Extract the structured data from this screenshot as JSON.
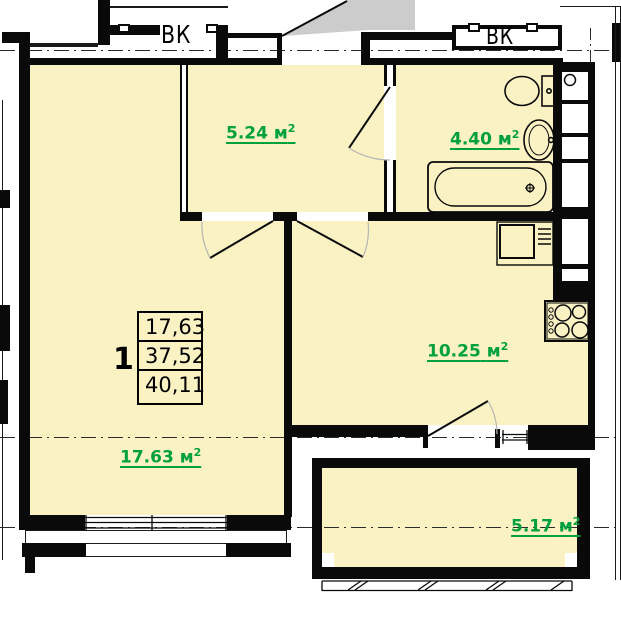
{
  "plan": {
    "vk_labels": {
      "left": "ВК",
      "right": "ВК"
    },
    "rooms": {
      "hallway": {
        "area": "5.24",
        "unit": "м",
        "power": "2"
      },
      "bathroom": {
        "area": "4.40",
        "unit": "м",
        "power": "2"
      },
      "kitchen": {
        "area": "10.25",
        "unit": "м",
        "power": "2"
      },
      "living_room": {
        "area": "17.63",
        "unit": "м",
        "power": "2"
      },
      "balcony": {
        "area": "5.17",
        "unit": "м",
        "power": "2"
      }
    },
    "apartment_stats": {
      "rooms_count": "1",
      "living_area": "17,63",
      "heated_area": "37,52",
      "total_area": "40,11"
    },
    "colors": {
      "room_fill": "#FAF2C3",
      "area_label_green": "#00A03E",
      "corridor_gray": "#CCCCCC",
      "wall_black": "#0A0A0A"
    }
  }
}
